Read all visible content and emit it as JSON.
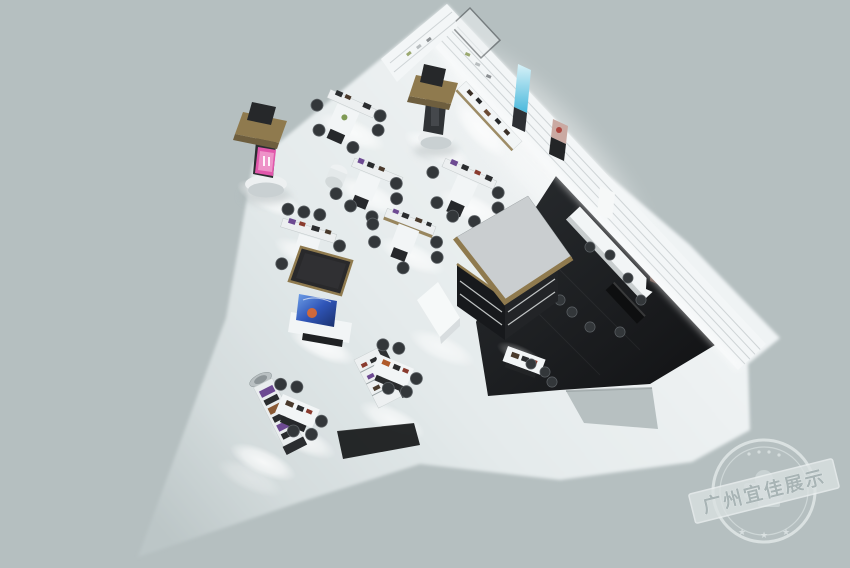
{
  "scene": {
    "label": "3D aerial render of a cosmetics retail store interior",
    "zones": {
      "showroom_floor": "white wedge-shaped sales floor",
      "lounge": "dark marble floor zone with bar counter",
      "perimeter": "white slat shelving wall with posters"
    }
  },
  "watermark": {
    "text": "广州宜佳展示",
    "shape": "circular-stamp-with-diagonal-ribbon"
  },
  "colors": {
    "background": "#b5bfc0",
    "floor": "#eff3f4",
    "floor_mid": "#e4eaeb",
    "floor_fade": "#bcc6c7",
    "wall": "#f3f6f7",
    "wall_slat": "#c8ced0",
    "dark_floor": "#26292c",
    "dark_floor_deep": "#121315",
    "gold_trim": "#8f7a4e",
    "canopy_gray": "#caced0",
    "canopy_black": "#29292b",
    "kiosk_base": "#17191c",
    "counter_white": "#f2f5f6",
    "stool": "#33373a",
    "stool_rim": "#5c6165",
    "product_purple": "#6d4a92",
    "screen_pink": "#e157ab",
    "screen_blue": "#2f55b8",
    "screen_orange": "#e06a2e",
    "poster_cyan": "#49b8dc",
    "face_tone": "#d8b49a",
    "mat_black": "#1a1c1e",
    "notch_gray": "#b7c0c1",
    "watermark_ink": "#e9efef"
  }
}
